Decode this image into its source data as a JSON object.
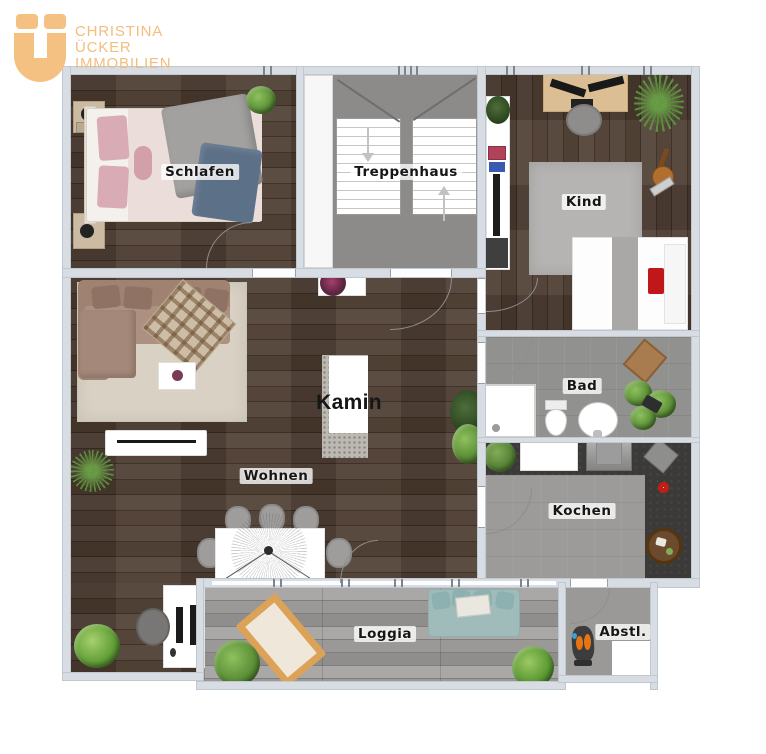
{
  "logo": {
    "line1": "CHRISTINA",
    "line2": "ÜCKER",
    "line3": "IMMOBILIEN",
    "color": "#f3bd7d"
  },
  "rooms": {
    "schlafen": "Schlafen",
    "treppenhaus": "Treppenhaus",
    "kind": "Kind",
    "bad": "Bad",
    "kochen": "Kochen",
    "kamin": "Kamin",
    "wohnen": "Wohnen",
    "loggia": "Loggia",
    "abstellraum": "Abstl."
  },
  "colors": {
    "wall": "#d7dde2",
    "wood_floor": "#4a3a2f",
    "stair_floor": "#8c8b89",
    "bath_floor": "#91918f",
    "kitchen_counter": "#3b3a38",
    "kitchen_floor": "#9c9b99",
    "loggia_deck": "#a5a4a2",
    "logo_accent": "#f3bd7d",
    "living_sofa": "#a08273",
    "loggia_sofa": "#9fbcbb",
    "living_rug": "#d8d1c4",
    "kind_rug": "#b6b4b2"
  }
}
